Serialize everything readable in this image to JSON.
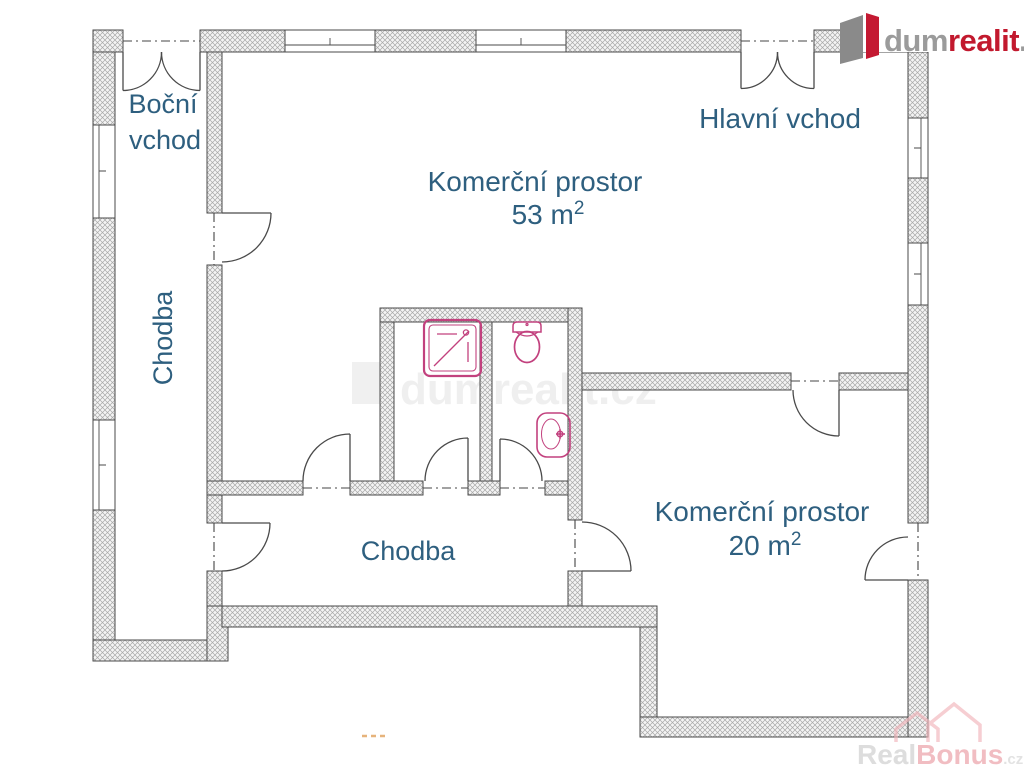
{
  "floorplan": {
    "rooms": {
      "side_entrance": {
        "line1": "Boční",
        "line2": "vchod"
      },
      "main_entrance": {
        "label": "Hlavní vchod"
      },
      "corridor_left": {
        "label": "Chodba"
      },
      "corridor_bottom": {
        "label": "Chodba"
      },
      "commercial_large": {
        "label": "Komerční prostor",
        "area": "53 m",
        "area_sup": "2"
      },
      "commercial_small": {
        "label": "Komerční prostor",
        "area": "20 m",
        "area_sup": "2"
      }
    },
    "fixtures": [
      "shower",
      "toilet",
      "sink"
    ],
    "colors": {
      "room_label": "#2e5f7f",
      "fixture": "#c2417e",
      "wall_outline": "#4a4a4a",
      "hatch_line": "#a8a8a8"
    }
  },
  "branding": {
    "logo_top_right": {
      "gray_part": "dum",
      "red_part": "realit",
      "suffix": ".cz"
    },
    "logo_colors": {
      "gray": "#9b9b9b",
      "red": "#c2192e",
      "icon_gray": "#8a8a8a",
      "icon_red": "#c41932"
    },
    "watermark_center": {
      "text": "dumrealit.cz"
    },
    "watermark_bottom_right": {
      "gray_part": "Real",
      "accent_part": "Bonus",
      "suffix": ".cz"
    },
    "watermark_colors": {
      "gray": "#cbcbcb",
      "accent": "#eb9aa2",
      "suffix": "#d4d4d4",
      "house": "#f2b5bb"
    }
  }
}
